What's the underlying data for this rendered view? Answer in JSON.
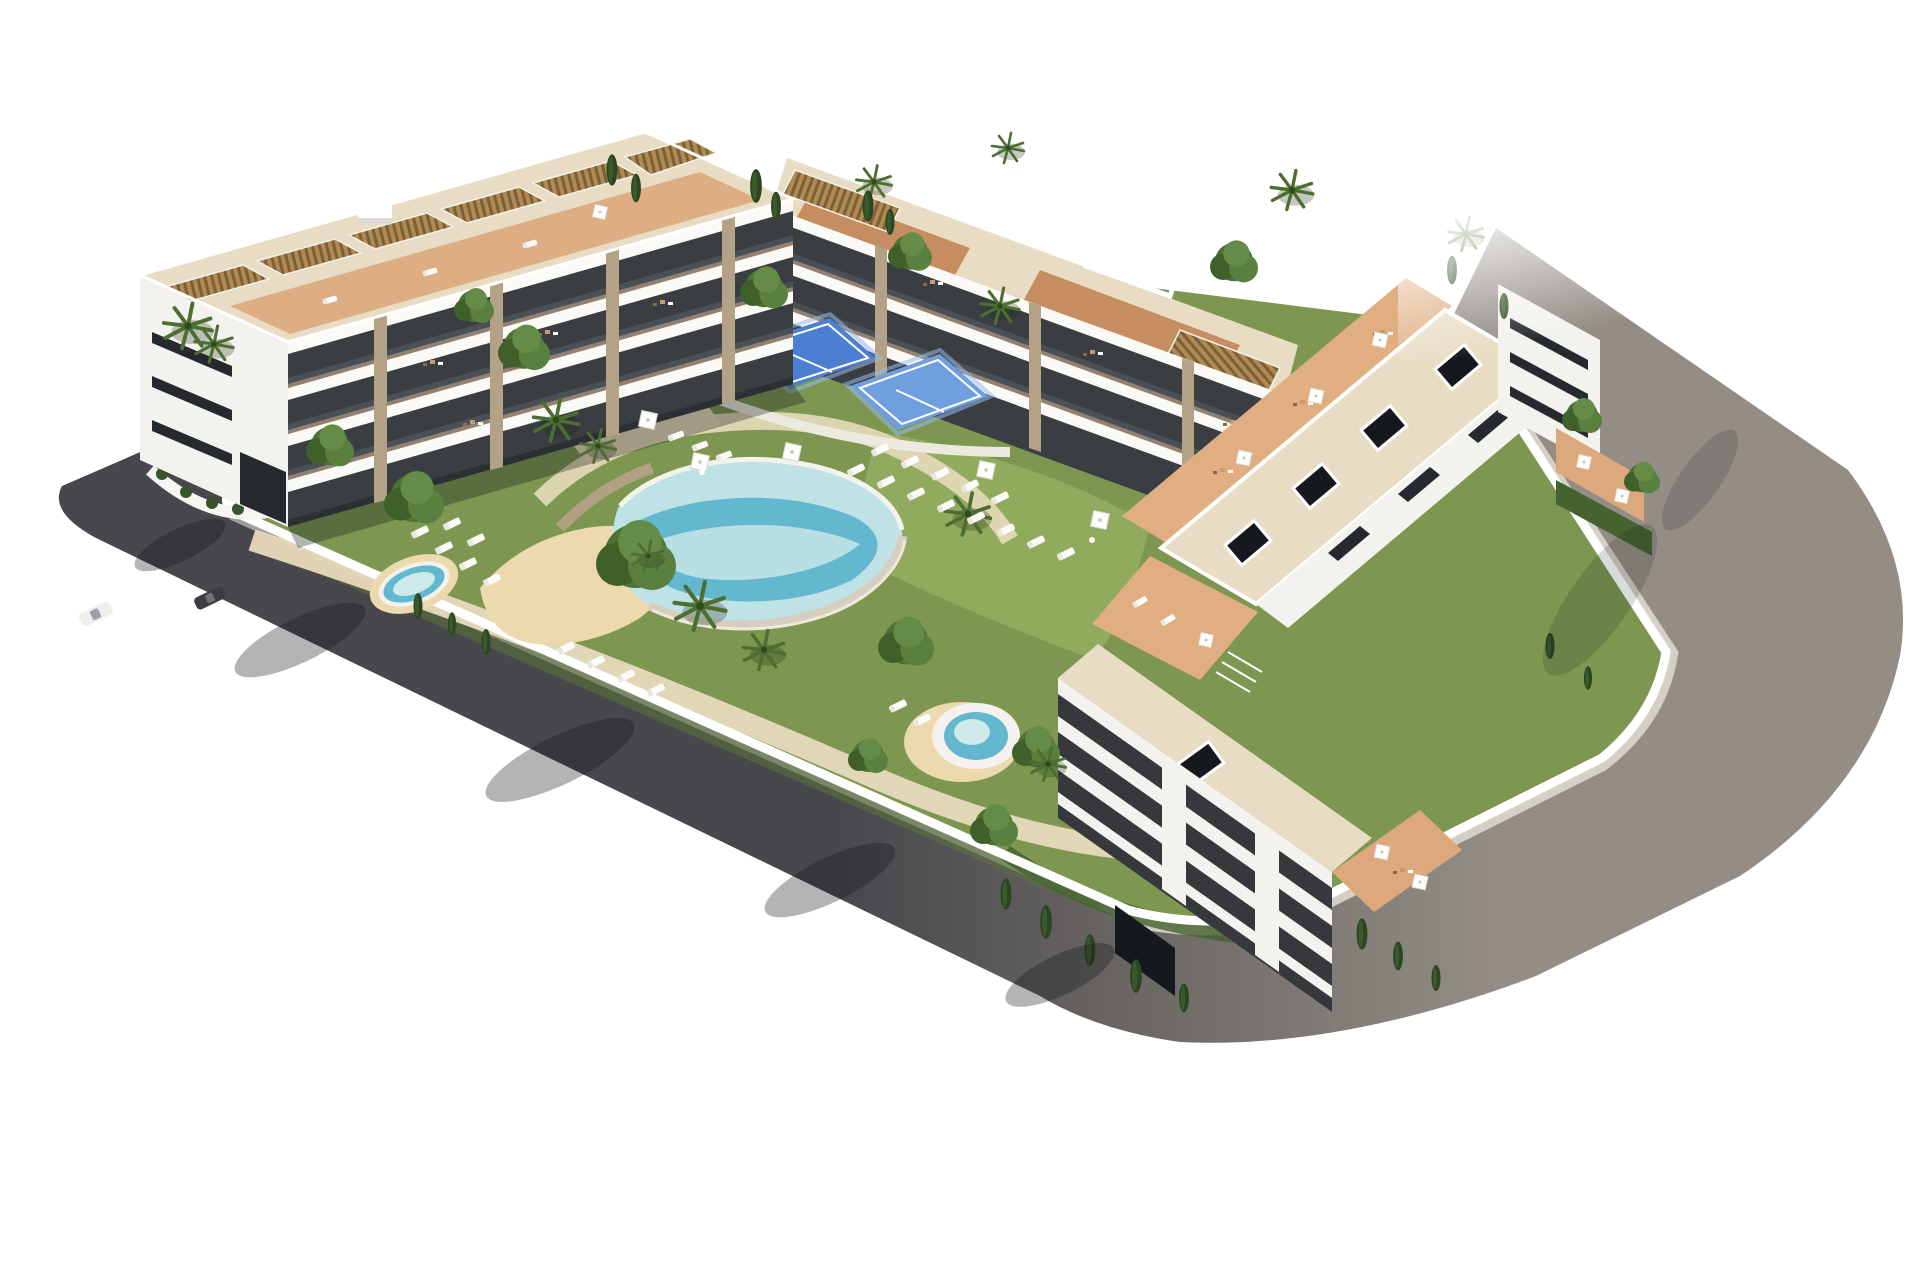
{
  "scene": {
    "title": "Aerial 3D architectural rendering of a residential apartment complex",
    "view": "isometric aerial view on a plain white background",
    "visible_elements": [
      "west apartment building with rooftop pergolas and tiered terraces",
      "north apartment building with terracotta roof terraces and white roof frame",
      "east apartment building with a row of slatted pergola roofs and skylight roof deck",
      "south lower block with dark horizontal window bands",
      "free-form central swimming pool with infinity edge and sandy beach deck",
      "small kidney-shaped children's pool",
      "round spa pool",
      "two blue sports courts with glass fencing",
      "landscaped gardens with palm trees, leafy trees and cypresses",
      "white sun loungers and square parasols",
      "perimeter asphalt road with sidewalks and curved corners",
      "white perimeter wall",
      "two parked cars",
      "tree shadows cast on the road"
    ],
    "building_count": 4,
    "pool_count": 3,
    "court_count": 2,
    "vehicle_count": 2
  },
  "palette": {
    "bg": "#ffffff",
    "road_dark": "#47474c",
    "road_mid": "#6e6a66",
    "road_light": "#938d86",
    "sidewalk_light": "#d8d3c9",
    "sidewalk_gray": "#a9a7a3",
    "wall_white": "#ffffff",
    "lawn": "#7d9751",
    "lawn_light": "#93ad60",
    "bed_green": "#45632f",
    "deck_beige": "#e7d9ba",
    "sand": "#ecd9ad",
    "pool_light": "#bfe2e6",
    "pool_deep": "#63b8cf",
    "pool_pale": "#cdeae8",
    "pool_rim": "#f4f2ec",
    "pool_wall": "#d6cfbf",
    "stone_wall": "#b2a082",
    "court_blue": "#4c7ed2",
    "court_blue2": "#6f9fe0",
    "facade_white": "#f4f2ee",
    "facade_void": "#3a3e42",
    "window_dark": "#26292d",
    "pillar_stone": "#b3a285",
    "slab_white": "#fbfaf7",
    "terracotta": "#dca87c",
    "terrace_light": "#e0ae81",
    "tile_roof": "#c68e60",
    "roof_deck": "#e8ddc4",
    "pergola_wood": "#b18a52",
    "pergola_gap": "#7b5f38",
    "skylight": "#15181c",
    "glass": "#566168",
    "shadow": "rgba(20,22,26,0.32)",
    "car_white": "#efefed",
    "car_dark": "#3c3c42"
  }
}
